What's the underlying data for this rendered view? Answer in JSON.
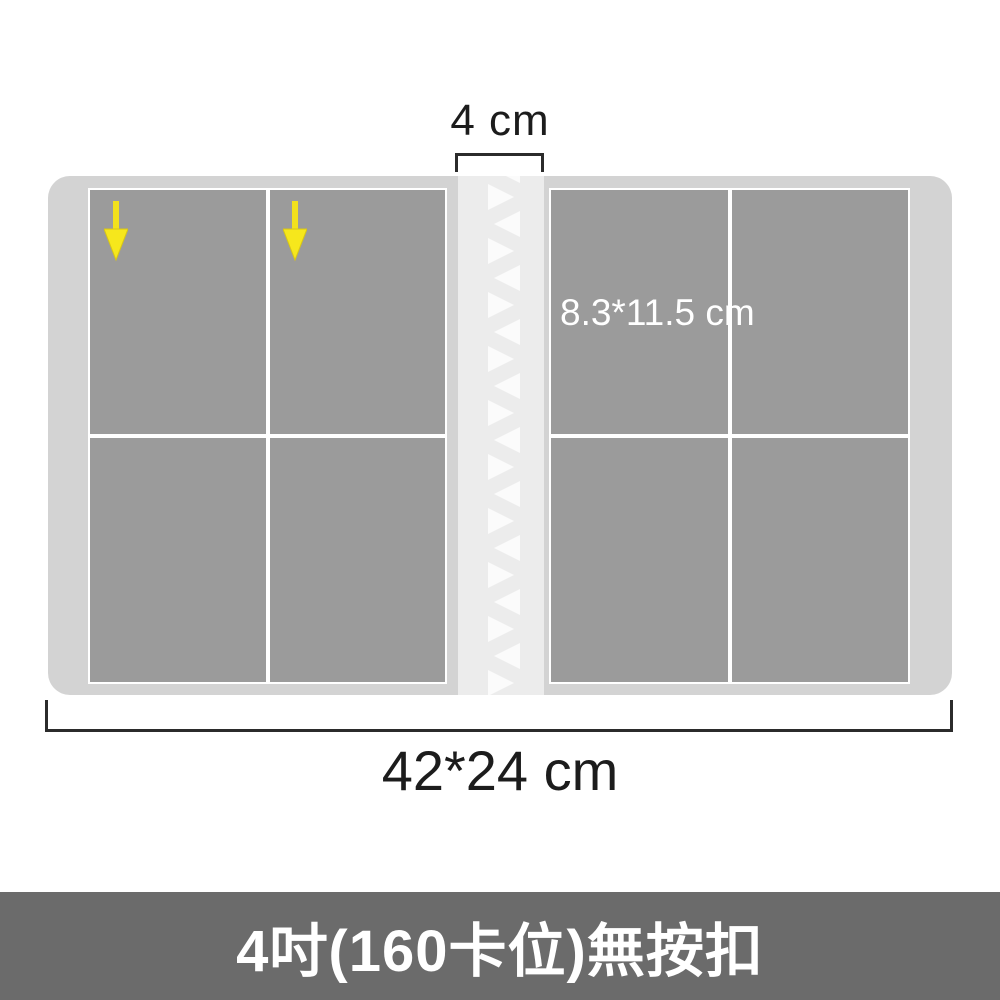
{
  "dimensions": {
    "spine_width_label": "4 cm",
    "album_size_label": "42*24 cm",
    "pocket_size_label": "8.3*11.5 cm"
  },
  "banner": {
    "title": "4吋(160卡位)無按扣"
  },
  "structure": {
    "pages": 2,
    "visible_slots_per_page": 4,
    "arrow_count": 2
  },
  "colors": {
    "background": "#ffffff",
    "album_cover": "#d3d3d3",
    "card_slot": "#9b9b9b",
    "slot_divider": "#ffffff",
    "spine": "#ececec",
    "spine_zigzag": "#fbfbfb",
    "arrow_yellow": "#f6e71c",
    "dimension_line": "#2b2b2b",
    "dimension_text": "#1c1c1c",
    "banner_background": "#6b6b6b",
    "banner_text": "#ffffff"
  }
}
